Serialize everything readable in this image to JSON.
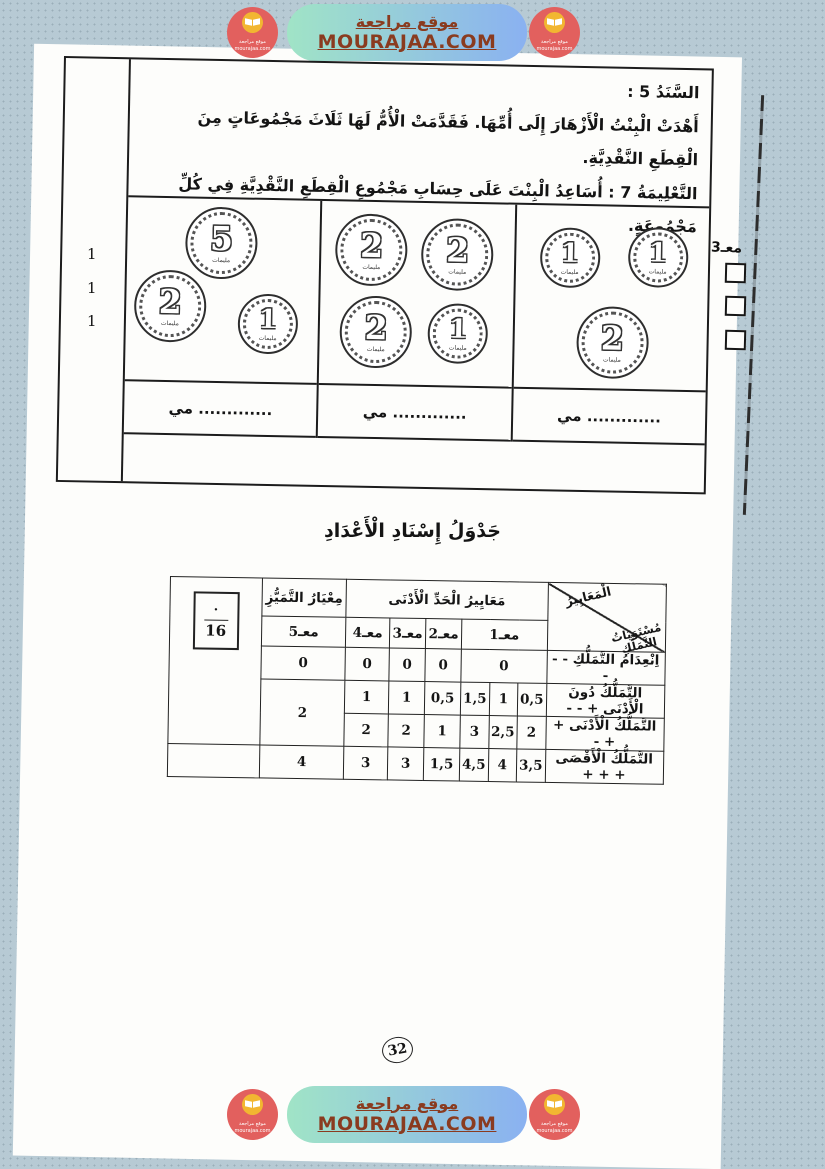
{
  "banner": {
    "site_name": "موقع مراجعة",
    "site_url": "MOURAJAA.COM",
    "logo": {
      "line1": "موقع مراجعة",
      "line2": "mourajaa.com"
    }
  },
  "colors": {
    "background": "#b7cad4",
    "banner_green": "#a0e4c6",
    "banner_blue": "#8ab1f1",
    "banner_text_brown": "#8a3b1f",
    "logo_red": "#e2605e",
    "logo_yellow": "#f2b631"
  },
  "exercise": {
    "support_label": "السَّنَدُ 5 :",
    "support_text": "أَهْدَتْ الْبِنْتُ الْأَزْهَارَ إِلَى أُمِّهَا. فَقَدَّمَتْ الْأُمُّ لَهَا ثَلَاثَ مَجْمُوعَاتٍ مِنَ الْقِطَعِ النَّقْدِيَّةِ.",
    "instruction_label": "التَّعْلِيمَةُ 7 :",
    "instruction_text": "أُسَاعِدُ الْبِنْتَ عَلَى حِسَابِ مَجْمُوعِ الْقِطَعِ النَّقْدِيَّةِ فِي كُلِّ مَجْمُوعَةٍ.",
    "margin_marks": [
      "1",
      "1",
      "1"
    ],
    "side_criterion": "معـ3",
    "answer_line": "............. مي",
    "coin_unit": "مليمات",
    "coin_groups": [
      {
        "coins": [
          {
            "value": "5"
          },
          {
            "value": "2"
          },
          {
            "value": "1"
          }
        ]
      },
      {
        "coins": [
          {
            "value": "2"
          },
          {
            "value": "2"
          },
          {
            "value": "2"
          },
          {
            "value": "1"
          }
        ]
      },
      {
        "coins": [
          {
            "value": "1"
          },
          {
            "value": "1"
          },
          {
            "value": "2"
          }
        ]
      }
    ]
  },
  "table": {
    "title": "جَدْوَلُ إِسْنَادِ الْأَعْدَادِ",
    "corner_top": "الْمَعَايِيرُ",
    "corner_bottom_1": "مُسْتَوَيَاتُ",
    "corner_bottom_2": "التَّمَلُّكِ",
    "min_header": "مَعَايِيرُ الْحَدِّ الْأَدْنَى",
    "excellence_header": "مِعْيَارُ التَّمَيُّزِ",
    "criteria": [
      "معـ1",
      "معـ2",
      "معـ3",
      "معـ4",
      "معـ5"
    ],
    "rows": [
      {
        "label": "اِنْعِدَامُ التَّمَلُّكِ - - -",
        "m1": [
          "0"
        ],
        "m2": "0",
        "m3": "0",
        "m4": "0",
        "m5": "0"
      },
      {
        "label": "التَّمَلُّكُ دُونَ الْأَدْنَى + - -",
        "m1": [
          "0,5",
          "1",
          "1,5"
        ],
        "m2": "0,5",
        "m3": "1",
        "m4": "1",
        "m5": "2"
      },
      {
        "label": "التَّمَلُّكُ الْأَدْنَى + + -",
        "m1": [
          "2",
          "2,5",
          "3"
        ],
        "m2": "1",
        "m3": "2",
        "m4": "2"
      },
      {
        "label": "التَّمَلُّكُ الْأَقْصَى + + +",
        "m1": [
          "3,5",
          "4",
          "4,5"
        ],
        "m2": "1,5",
        "m3": "3",
        "m4": "3",
        "m5": "4"
      }
    ],
    "score": {
      "numerator": "·",
      "denominator": "16"
    }
  },
  "page_number": "32"
}
